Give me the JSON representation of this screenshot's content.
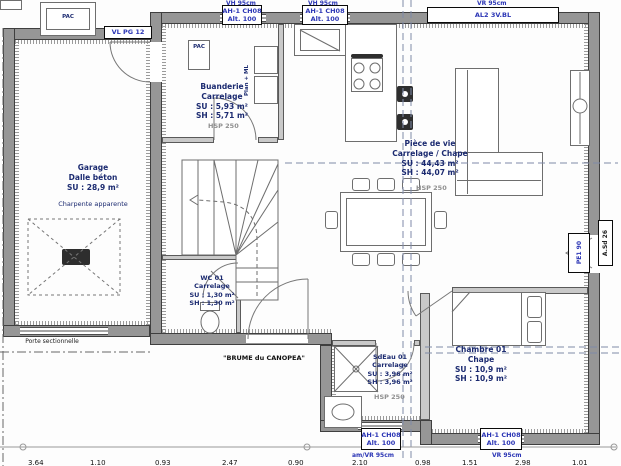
{
  "plan": {
    "colors": {
      "wall_gray": "#969696",
      "label_blue": "#2b35b5",
      "room_text_navy": "#1b2a70",
      "hsp_gray": "#8f8f8f"
    },
    "rooms": {
      "garage": {
        "name": "Garage",
        "floor": "Dalle béton",
        "su": "SU : 28,9 m²",
        "note": "Charpente apparente"
      },
      "buanderie": {
        "name": "Buanderie",
        "floor": "Carrelage",
        "su": "SU : 5,93 m²",
        "sh": "SH : 5,71 m²",
        "hsp": "HSP 250"
      },
      "wc": {
        "name": "WC 01",
        "floor": "Carrelage",
        "su": "SU : 1,30 m²",
        "sh": "SH : 1,30 m²"
      },
      "piece_de_vie": {
        "name": "Pièce de vie",
        "floor": "Carrelage / Chape",
        "su": "SU : 44,43 m²",
        "sh": "SH : 44,07 m²",
        "hsp": "HSP 250"
      },
      "sdeau": {
        "name": "SdEau 01",
        "floor": "Carrelage",
        "su": "SU : 3,96 m²",
        "sh": "SH : 3,96 m²",
        "hsp": "HSP 250"
      },
      "chambre": {
        "name": "Chambre 01",
        "floor": "Chape",
        "su": "SU : 10,9 m²",
        "sh": "SH : 10,9 m²"
      }
    },
    "equipment": {
      "pac_outdoor": "PAC",
      "pac_indoor": "PAC",
      "washer": "Plan + ML"
    },
    "doors": {
      "garage_door": "Porte sectionnelle",
      "front_door": "\"BRUME du CANOPEA\"",
      "side_door": "PE1 90",
      "right_marker": "A.Sd 26"
    },
    "windows": {
      "garage": "VL PG 12",
      "top1_l1": "AH-1 CH08",
      "top1_l2": "Alt. 100",
      "top1_note": "VH 95cm",
      "top2_l1": "AH-1 CH08",
      "top2_l2": "Alt. 100",
      "top2_note": "VH 95cm",
      "bay_l1": "AL2 3V.BL",
      "bay_note": "VR 95cm",
      "sdeau_l1": "AH-1 CH08",
      "sdeau_l2": "Alt. 100",
      "sdeau_note": "am/VR 95cm",
      "chambre_l1": "AH-1 CH08",
      "chambre_l2": "Alt. 100",
      "chambre_note": "VR 95cm"
    },
    "dims": [
      "3.64",
      "1.10",
      "0.93",
      "2.47",
      "0.90",
      "2.10",
      "0.98",
      "1.51",
      "2.98",
      "1.01"
    ]
  }
}
